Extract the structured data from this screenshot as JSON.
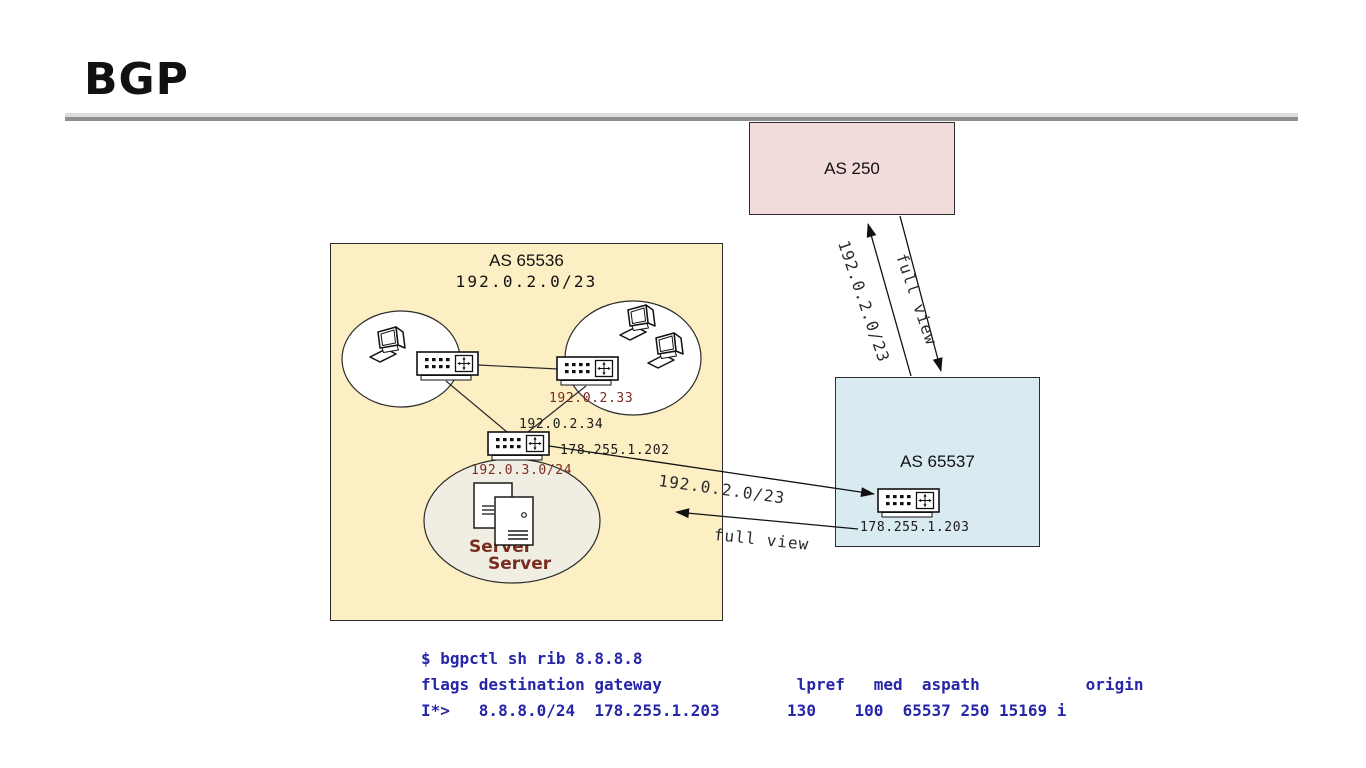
{
  "slide": {
    "title": "BGP"
  },
  "as250": {
    "label": "AS 250"
  },
  "as65536": {
    "label": "AS 65536",
    "prefix": "192.0.2.0/23",
    "router_right_ip": "192.0.2.33",
    "router_core_ip": "192.0.2.34",
    "router_core_wan_ip": "178.255.1.202",
    "server_lan_prefix": "192.0.3.0/24",
    "server_back_label": "Server",
    "server_front_label": "Server"
  },
  "as65537": {
    "label": "AS 65537",
    "router_ip": "178.255.1.203"
  },
  "peering_side": {
    "announce_label": "192.0.2.0/23",
    "fullview_label": "full view"
  },
  "peering_up": {
    "announce_label": "192.0.2.0/23",
    "fullview_label": "full view"
  },
  "terminal": {
    "line1": "$ bgpctl sh rib 8.8.8.8",
    "line2": "flags destination gateway              lpref   med  aspath           origin",
    "line3": "I*>   8.8.8.0/24  178.255.1.203       130    100  65537 250 15169 i"
  },
  "colors": {
    "as250_fill": "#f2dcdb",
    "as65536_fill": "#fcefc3",
    "as65537_fill": "#daeaf1",
    "server_lan_fill": "#f0eee3",
    "ip_label_maroon": "#7a2c21",
    "terminal_blue": "#2626a8"
  }
}
